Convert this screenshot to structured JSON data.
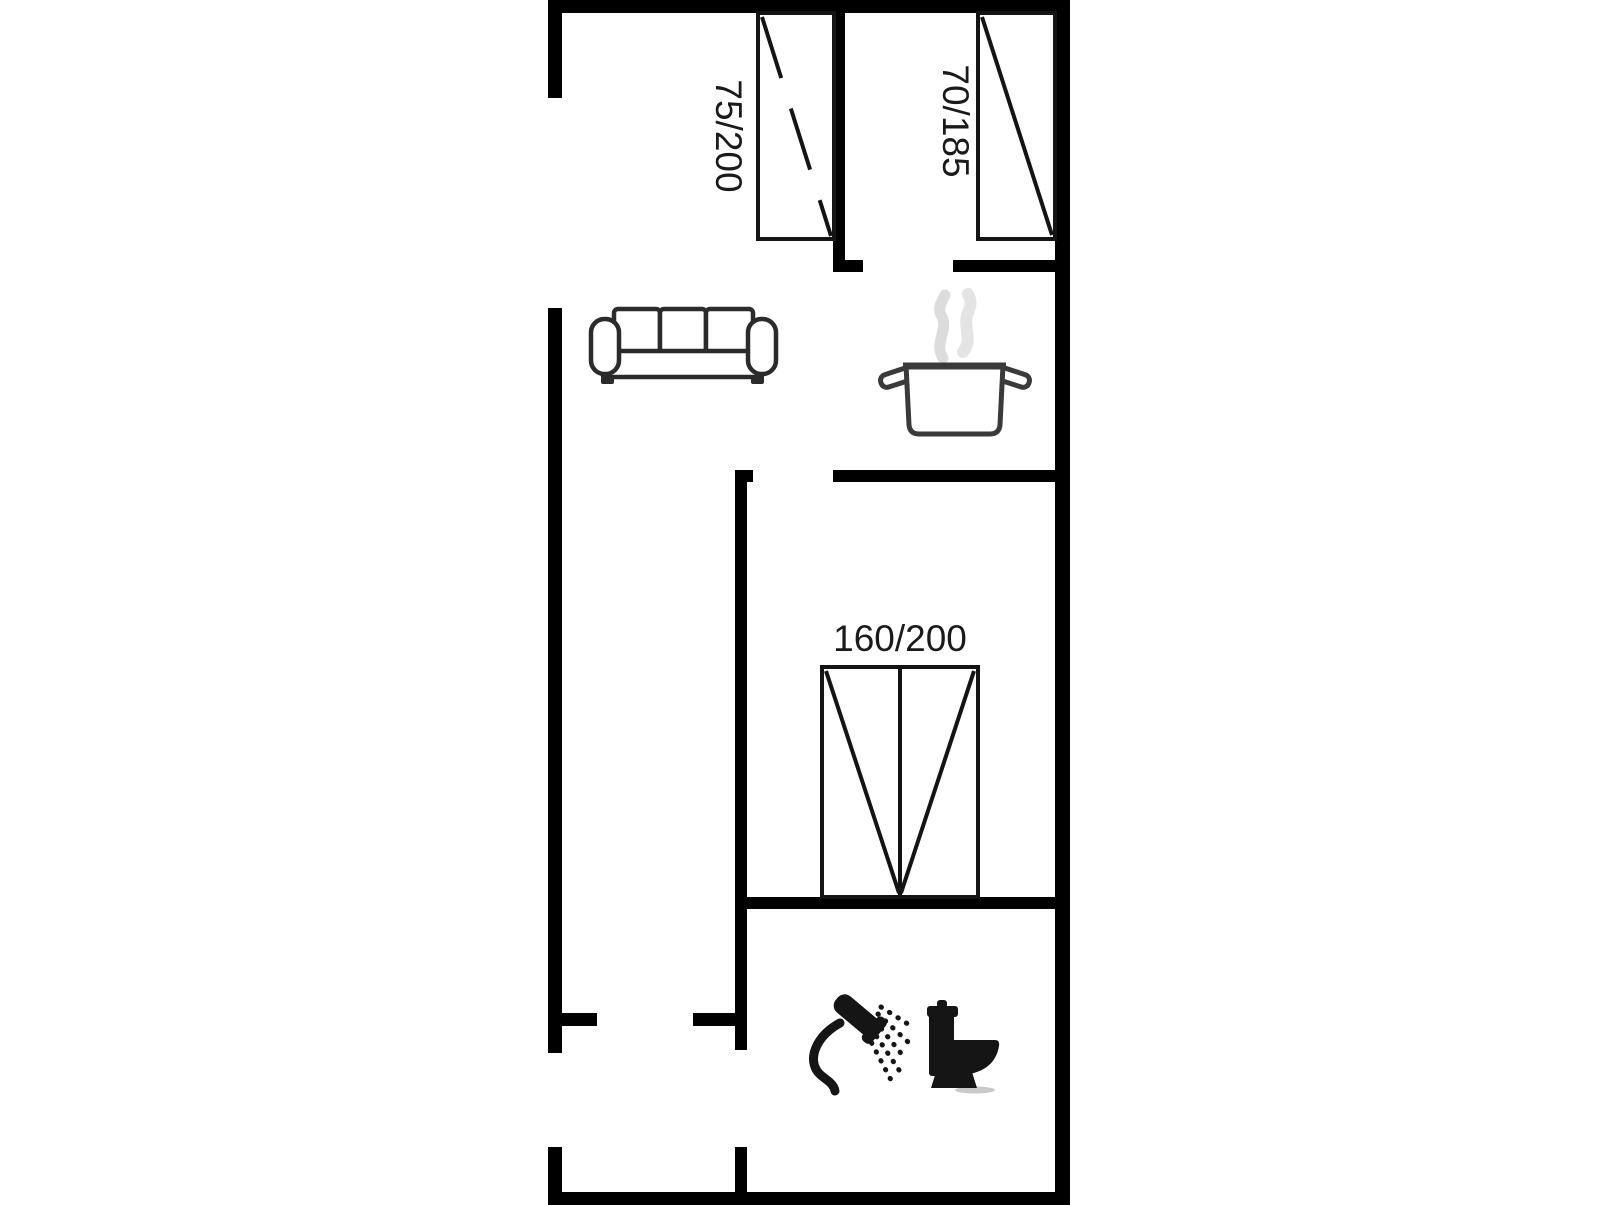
{
  "figure": {
    "kind": "floor-plan",
    "background": "#ffffff",
    "wall_color": "#000000",
    "furniture_outline_color": "#2b2b2b",
    "fixture_color": "#151515",
    "steam_color": "#dcdcdc",
    "label_color": "#1a1a1a",
    "beds": [
      {
        "label": "75/200"
      },
      {
        "label": "70/185"
      },
      {
        "label": "160/200"
      }
    ],
    "icons": [
      {
        "name": "sofa-icon"
      },
      {
        "name": "cooking-pot-icon"
      },
      {
        "name": "shower-icon"
      },
      {
        "name": "toilet-icon"
      }
    ]
  }
}
